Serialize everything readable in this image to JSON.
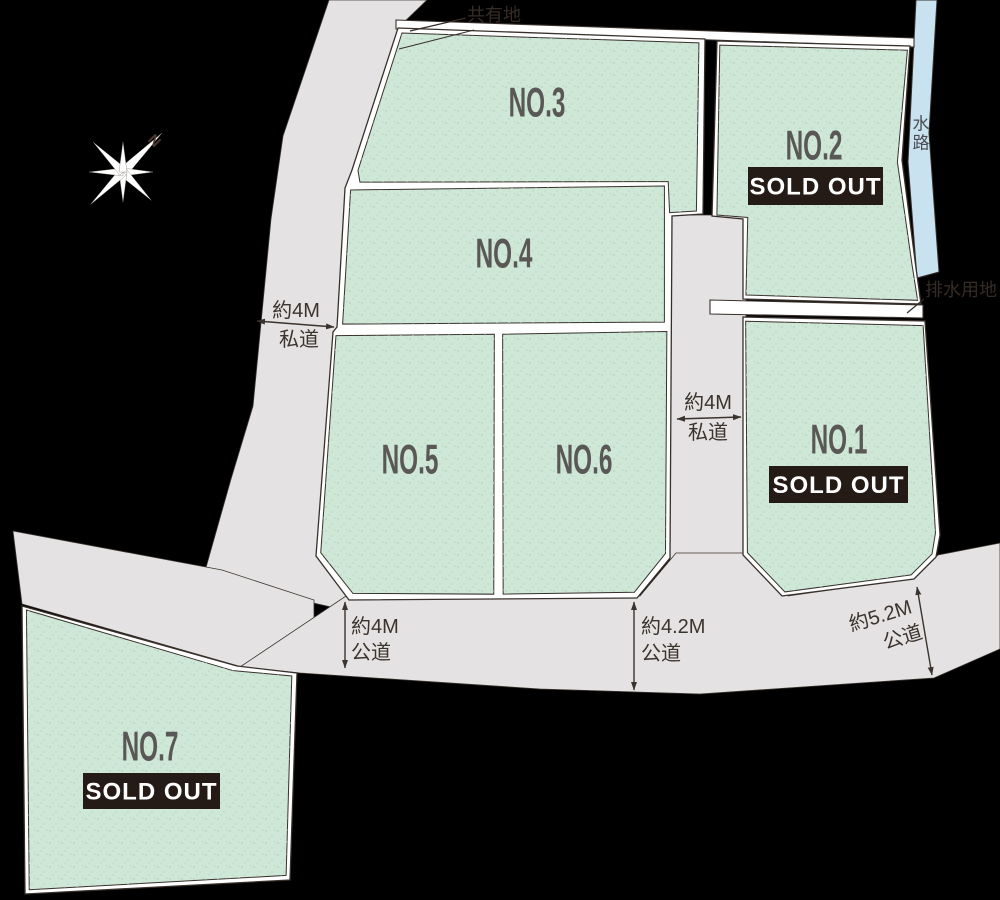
{
  "canvas": {
    "width": 1000,
    "height": 900,
    "background": "#000000"
  },
  "colors": {
    "road": "#e4e2e2",
    "road_edge": "#3c352f",
    "block_white": "#ffffff",
    "outline": "#38302b",
    "lot_green": "#cfe7d7",
    "speckle": "#b2d3c1",
    "waterway_fill": "#c9e2f0",
    "lot_label": "#5a5757",
    "dim_text": "#3b332d",
    "ann_text": "#362c25",
    "waterway_text": "#4c4c52",
    "badge_bg": "#241b16",
    "badge_text": "#ffffff",
    "compass_fill": "#ffffff",
    "compass_edge": "#8c867f",
    "compass_n": "#4c3a31"
  },
  "roads": [
    {
      "name": "west-private-road",
      "points": [
        [
          329,
          0
        ],
        [
          427,
          0
        ],
        [
          398,
          28
        ],
        [
          355,
          170
        ],
        [
          348,
          188
        ],
        [
          341,
          327
        ],
        [
          336,
          333
        ],
        [
          319,
          556
        ],
        [
          352,
          600
        ],
        [
          353,
          612
        ],
        [
          203,
          578
        ],
        [
          231,
          479
        ],
        [
          253,
          406
        ],
        [
          271,
          219
        ],
        [
          283,
          136
        ]
      ]
    },
    {
      "name": "west-spur-road",
      "points": [
        [
          13,
          531
        ],
        [
          222,
          570
        ],
        [
          314,
          600
        ],
        [
          314,
          660
        ],
        [
          242,
          667
        ],
        [
          22,
          604
        ]
      ]
    },
    {
      "name": "center-private-road",
      "points": [
        [
          670,
          215
        ],
        [
          746,
          215
        ],
        [
          746,
          602
        ],
        [
          670,
          602
        ]
      ]
    },
    {
      "name": "south-public-road",
      "points": [
        [
          240,
          667
        ],
        [
          346,
          596
        ],
        [
          640,
          596
        ],
        [
          676,
          553
        ],
        [
          746,
          553
        ],
        [
          788,
          596
        ],
        [
          914,
          578
        ],
        [
          938,
          555
        ],
        [
          1000,
          543
        ],
        [
          1000,
          649
        ],
        [
          934,
          678
        ],
        [
          700,
          694
        ],
        [
          540,
          689
        ],
        [
          300,
          673
        ]
      ]
    }
  ],
  "waterway": {
    "label": "水路",
    "points": [
      [
        916,
        0
      ],
      [
        937,
        0
      ],
      [
        929,
        133
      ],
      [
        939,
        272
      ],
      [
        917,
        278
      ],
      [
        908,
        162
      ]
    ],
    "label_x": 921,
    "label_y": 124,
    "char_step": 19
  },
  "strips": [
    {
      "name": "shared-land-strip",
      "points": [
        [
          396,
          20
        ],
        [
          914,
          38
        ],
        [
          914,
          47
        ],
        [
          396,
          29
        ]
      ]
    },
    {
      "name": "drainage-strip",
      "points": [
        [
          710,
          300
        ],
        [
          923,
          305
        ],
        [
          923,
          318
        ],
        [
          710,
          314
        ]
      ]
    }
  ],
  "blocks": [
    {
      "name": "block-main",
      "points": [
        [
          398,
          28
        ],
        [
          705,
          39
        ],
        [
          703,
          214
        ],
        [
          672,
          216
        ],
        [
          670,
          558
        ],
        [
          637,
          598
        ],
        [
          349,
          600
        ],
        [
          316,
          556
        ],
        [
          333,
          332
        ],
        [
          337,
          327
        ],
        [
          345,
          188
        ],
        [
          352,
          170
        ]
      ]
    },
    {
      "name": "block-no2",
      "points": [
        [
          717,
          41
        ],
        [
          910,
          46
        ],
        [
          902,
          160
        ],
        [
          916,
          268
        ],
        [
          921,
          304
        ],
        [
          743,
          299
        ],
        [
          743,
          219
        ],
        [
          712,
          216
        ]
      ]
    },
    {
      "name": "block-no1",
      "points": [
        [
          743,
          317
        ],
        [
          925,
          321
        ],
        [
          940,
          535
        ],
        [
          936,
          557
        ],
        [
          914,
          579
        ],
        [
          782,
          596
        ],
        [
          743,
          555
        ]
      ]
    },
    {
      "name": "block-no7",
      "points": [
        [
          22,
          606
        ],
        [
          237,
          666
        ],
        [
          297,
          673
        ],
        [
          290,
          880
        ],
        [
          25,
          894
        ]
      ]
    }
  ],
  "lots": [
    {
      "id": "no1",
      "label": "NO.1",
      "sold_out": true,
      "badge": "SOLD OUT",
      "points": [
        [
          743,
          317
        ],
        [
          925,
          321
        ],
        [
          940,
          535
        ],
        [
          936,
          557
        ],
        [
          914,
          579
        ],
        [
          782,
          596
        ],
        [
          743,
          555
        ]
      ],
      "label_pos": [
        839,
        440
      ],
      "badge_rect": [
        769,
        466,
        139,
        37
      ],
      "inset": 5
    },
    {
      "id": "no2",
      "label": "NO.2",
      "sold_out": true,
      "badge": "SOLD OUT",
      "points": [
        [
          717,
          41
        ],
        [
          910,
          46
        ],
        [
          902,
          160
        ],
        [
          916,
          268
        ],
        [
          921,
          304
        ],
        [
          743,
          299
        ],
        [
          743,
          219
        ],
        [
          712,
          216
        ]
      ],
      "label_pos": [
        814,
        146
      ],
      "badge_rect": [
        748,
        167,
        135,
        38
      ],
      "inset": 5
    },
    {
      "id": "no3",
      "label": "NO.3",
      "sold_out": false,
      "points": [
        [
          398,
          30
        ],
        [
          703,
          40
        ],
        [
          701,
          213
        ],
        [
          674,
          215
        ],
        [
          673,
          183
        ],
        [
          355,
          183
        ],
        [
          353,
          171
        ]
      ],
      "label_pos": [
        537,
        103
      ],
      "inset": 5
    },
    {
      "id": "no4",
      "label": "NO.4",
      "sold_out": false,
      "points": [
        [
          346,
          188
        ],
        [
          669,
          184
        ],
        [
          669,
          324
        ],
        [
          338,
          326
        ]
      ],
      "label_pos": [
        504,
        254
      ],
      "inset": 5
    },
    {
      "id": "no5",
      "label": "NO.5",
      "sold_out": false,
      "points": [
        [
          334,
          331
        ],
        [
          497,
          330
        ],
        [
          497,
          598
        ],
        [
          351,
          598
        ],
        [
          317,
          556
        ]
      ],
      "label_pos": [
        410,
        460
      ],
      "inset": 5
    },
    {
      "id": "no6",
      "label": "NO.6",
      "sold_out": false,
      "points": [
        [
          500,
          330
        ],
        [
          669,
          327
        ],
        [
          669,
          557
        ],
        [
          636,
          597
        ],
        [
          500,
          598
        ]
      ],
      "label_pos": [
        584,
        460
      ],
      "inset": 5
    },
    {
      "id": "no7",
      "label": "NO.7",
      "sold_out": true,
      "badge": "SOLD OUT",
      "points": [
        [
          22,
          606
        ],
        [
          237,
          666
        ],
        [
          297,
          673
        ],
        [
          290,
          880
        ],
        [
          25,
          894
        ]
      ],
      "label_pos": [
        150,
        747
      ],
      "badge_rect": [
        83,
        773,
        137,
        36
      ],
      "inset": 6
    }
  ],
  "dimensions": [
    {
      "name": "west-private-road-width",
      "lines": [
        [
          "約4M",
          296,
          311
        ],
        [
          "私道",
          299,
          340
        ]
      ],
      "anchor": "middle",
      "arrow": [
        257,
        321,
        334,
        327
      ]
    },
    {
      "name": "center-private-road-width",
      "lines": [
        [
          "約4M",
          708,
          403
        ],
        [
          "私道",
          708,
          433
        ]
      ],
      "anchor": "middle",
      "arrow": [
        677,
        419,
        741,
        417
      ]
    },
    {
      "name": "south-road-width-4m",
      "lines": [
        [
          "約4M",
          351,
          627
        ],
        [
          "公道",
          351,
          653
        ]
      ],
      "anchor": "start",
      "arrow": [
        345,
        602,
        345,
        668
      ]
    },
    {
      "name": "south-road-width-4-2m",
      "lines": [
        [
          "約4.2M",
          641,
          627
        ],
        [
          "公道",
          641,
          654
        ]
      ],
      "anchor": "start",
      "arrow": [
        634,
        602,
        634,
        690
      ]
    },
    {
      "name": "southeast-road-width-5-2m",
      "lines": [
        [
          "約5.2M",
          884,
          614
        ],
        [
          "公道",
          899,
          641
        ]
      ],
      "anchor": "middle",
      "rotate": -17,
      "rotate_center": [
        890,
        627
      ],
      "arrow": [
        917,
        587,
        932,
        675
      ]
    }
  ],
  "annotations": {
    "shared_land": {
      "text": "共有地",
      "pos": [
        494,
        15
      ],
      "leader": [
        [
          466,
          18
        ],
        [
          410,
          31
        ]
      ],
      "sliver_line": [
        [
          399,
          49
        ],
        [
          474,
          30
        ]
      ]
    },
    "drainage": {
      "text": "排水用地",
      "pos": [
        961,
        290
      ],
      "leader": [
        [
          924,
          299
        ],
        [
          907,
          313
        ]
      ]
    }
  },
  "compass": {
    "n": "N",
    "center": [
      123,
      172
    ],
    "n_pos": [
      154,
      141
    ],
    "n_rotate": 45,
    "rays": [
      [
        -45,
        55,
        5
      ],
      [
        0,
        30,
        4
      ],
      [
        45,
        40,
        4.5
      ],
      [
        90,
        30,
        4
      ],
      [
        135,
        46,
        4.5
      ],
      [
        180,
        34,
        4
      ],
      [
        -135,
        42,
        4.5
      ],
      [
        -90,
        30,
        4
      ]
    ]
  }
}
